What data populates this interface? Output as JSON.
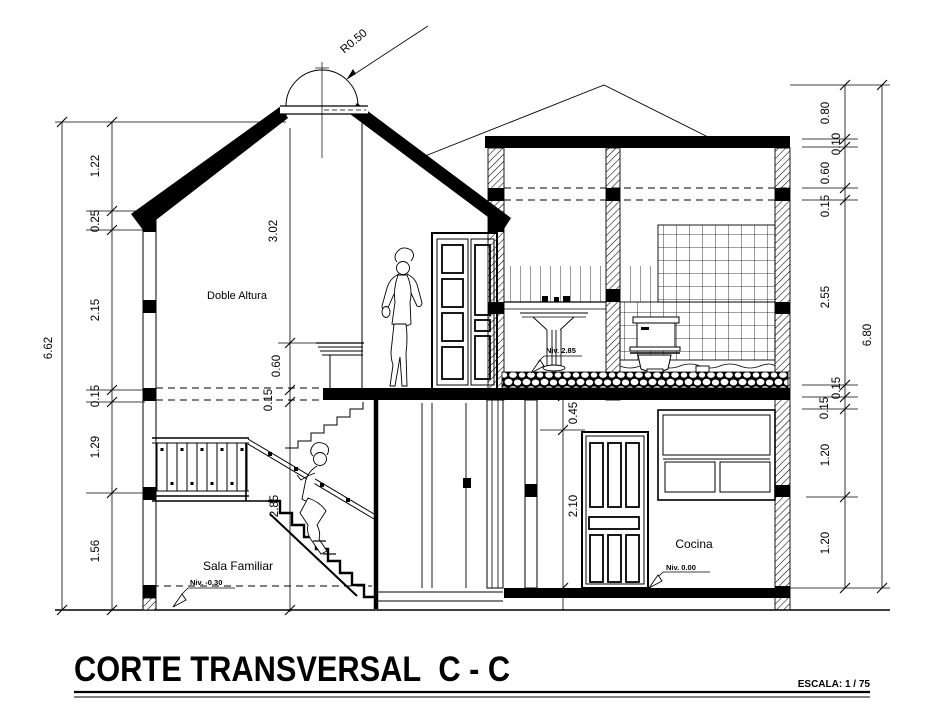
{
  "title": {
    "text": "CORTE TRANSVERSAL  C - C",
    "scale": "ESCALA: 1 / 75"
  },
  "labels": {
    "double_height": "Doble Altura",
    "family_room": "Sala Familiar",
    "kitchen": "Cocina",
    "dome_radius": "R0.50",
    "level_bath": "Niv. 2.85",
    "level_ground": "Niv. 0.00",
    "level_sala": "Niv. -0.30"
  },
  "dimensions": {
    "left_outer": "6.62",
    "left_chain": [
      "1.22",
      "0.25",
      "2.15",
      "0.15",
      "1.29",
      "1.56"
    ],
    "center_upper": [
      "3.02",
      "0.60",
      "0.15"
    ],
    "stair_height": "2.85",
    "right_inner": [
      "0.45",
      "2.10"
    ],
    "right_chain": [
      "0.80",
      "0.10",
      "0.60",
      "0.15",
      "2.55",
      "0.15",
      "0.15",
      "1.20",
      "1.20"
    ],
    "right_outer": "6.80"
  }
}
